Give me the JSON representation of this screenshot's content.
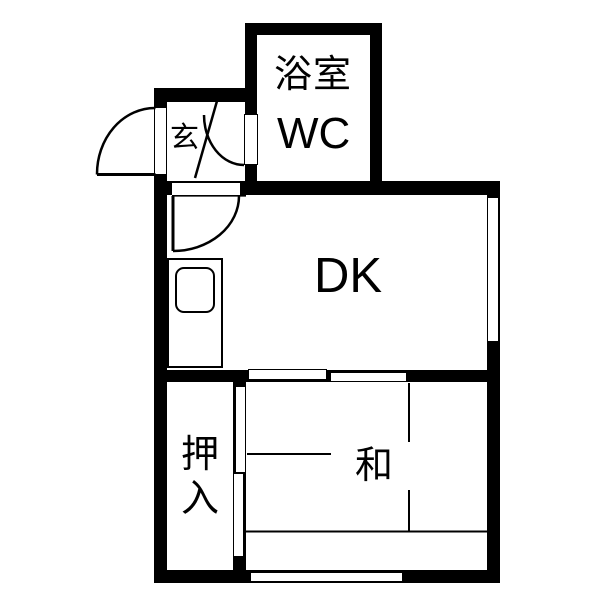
{
  "floorplan": {
    "type": "japanese-apartment-floorplan",
    "colors": {
      "wall": "#000000",
      "floor": "#ffffff",
      "line": "#000000"
    },
    "rooms": {
      "bath": {
        "line1": "浴室",
        "line2": "WC"
      },
      "genkan": {
        "label": "玄"
      },
      "dk": {
        "label": "DK"
      },
      "washitsu": {
        "label": "和"
      },
      "oshiire": {
        "line1": "押",
        "line2": "入"
      }
    },
    "fixtures": [
      "entrance-swing-door",
      "bath-wc-swing-door",
      "dk-swing-door",
      "genkan-step-line",
      "kitchen-counter-with-sink",
      "sliding-doors-dk-washitsu",
      "sliding-doors-oshiire",
      "window-right",
      "window-bottom",
      "tatami-division-lines"
    ]
  }
}
